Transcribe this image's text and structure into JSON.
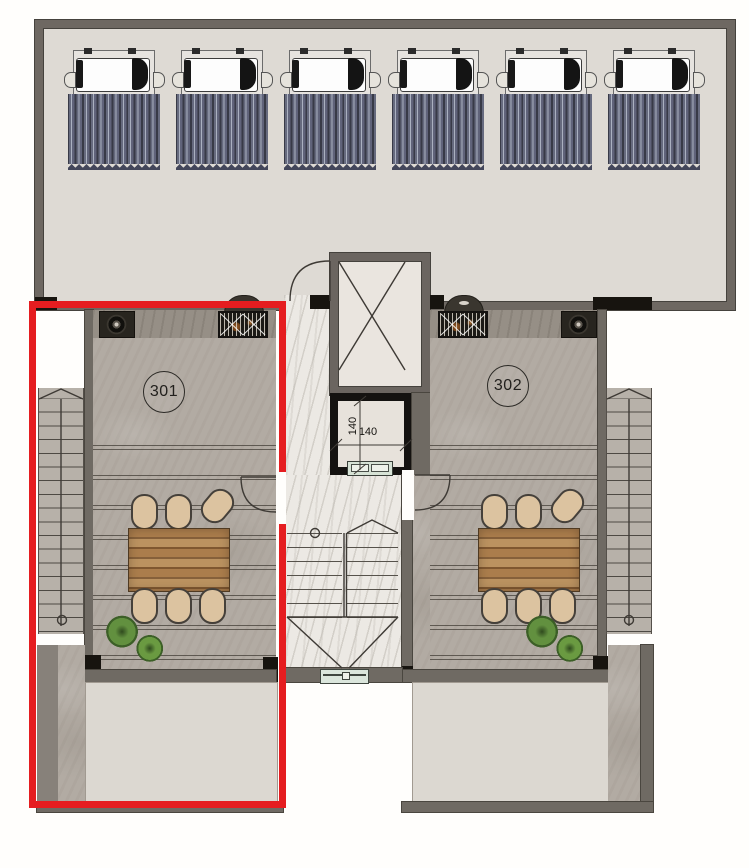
{
  "floor_plan": {
    "units": [
      {
        "label": "301"
      },
      {
        "label": "302"
      }
    ],
    "elevator_car": {
      "width_label": "140",
      "depth_label": "140"
    },
    "solar_panels": {
      "count": 6
    },
    "colors": {
      "selection_outline": "#e51d20",
      "wall": "#6f6a63",
      "wall_dark": "#17140f",
      "roof_deck": "#dedad4",
      "unit_floor": "#b2aba3",
      "corridor_marble": "#ece9e4",
      "lower_terrace": "#dcd8d1",
      "table_wood": "#a87c4e",
      "chair": "#dcc3a0",
      "plant": "#5a8440",
      "solar_tube": "#5f627a",
      "elevator_interior": "#eae5df"
    }
  }
}
